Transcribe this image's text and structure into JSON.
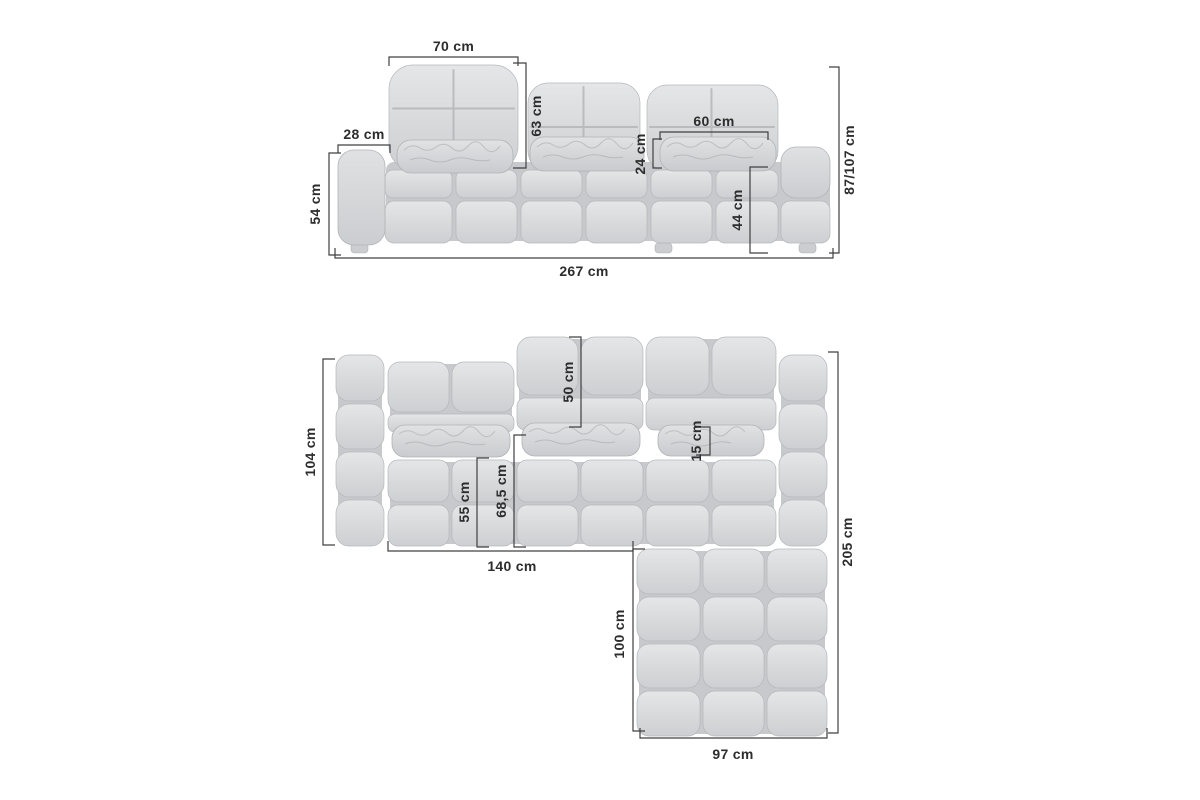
{
  "view_front": {
    "label": "front view",
    "dims": {
      "headrest_width": "70 cm",
      "armrest_width": "28 cm",
      "backrest_height": "63 cm",
      "seat_cushion_width": "60 cm",
      "seat_cushion_height": "24 cm",
      "overall_height": "87/107 cm",
      "armrest_height": "54 cm",
      "seat_height": "44 cm",
      "overall_width": "267 cm"
    }
  },
  "view_top": {
    "label": "top view",
    "dims": {
      "body_depth": "104 cm",
      "backrest_depth": "50 cm",
      "pillow_depth": "15 cm",
      "seat_depth": "55 cm",
      "seat_depth_with_pillow": "68,5 cm",
      "left_section_width": "140 cm",
      "overall_depth": "205 cm",
      "chaise_extension_length": "100 cm",
      "chaise_width": "97 cm"
    }
  },
  "colors": {
    "background": "#ffffff",
    "upholstery_light": "#e4e6e8",
    "upholstery_mid": "#cfd1d4",
    "upholstery_shadow": "#c7c9cc",
    "dimension_line": "#404040",
    "dimension_text": "#2d2d2d"
  }
}
